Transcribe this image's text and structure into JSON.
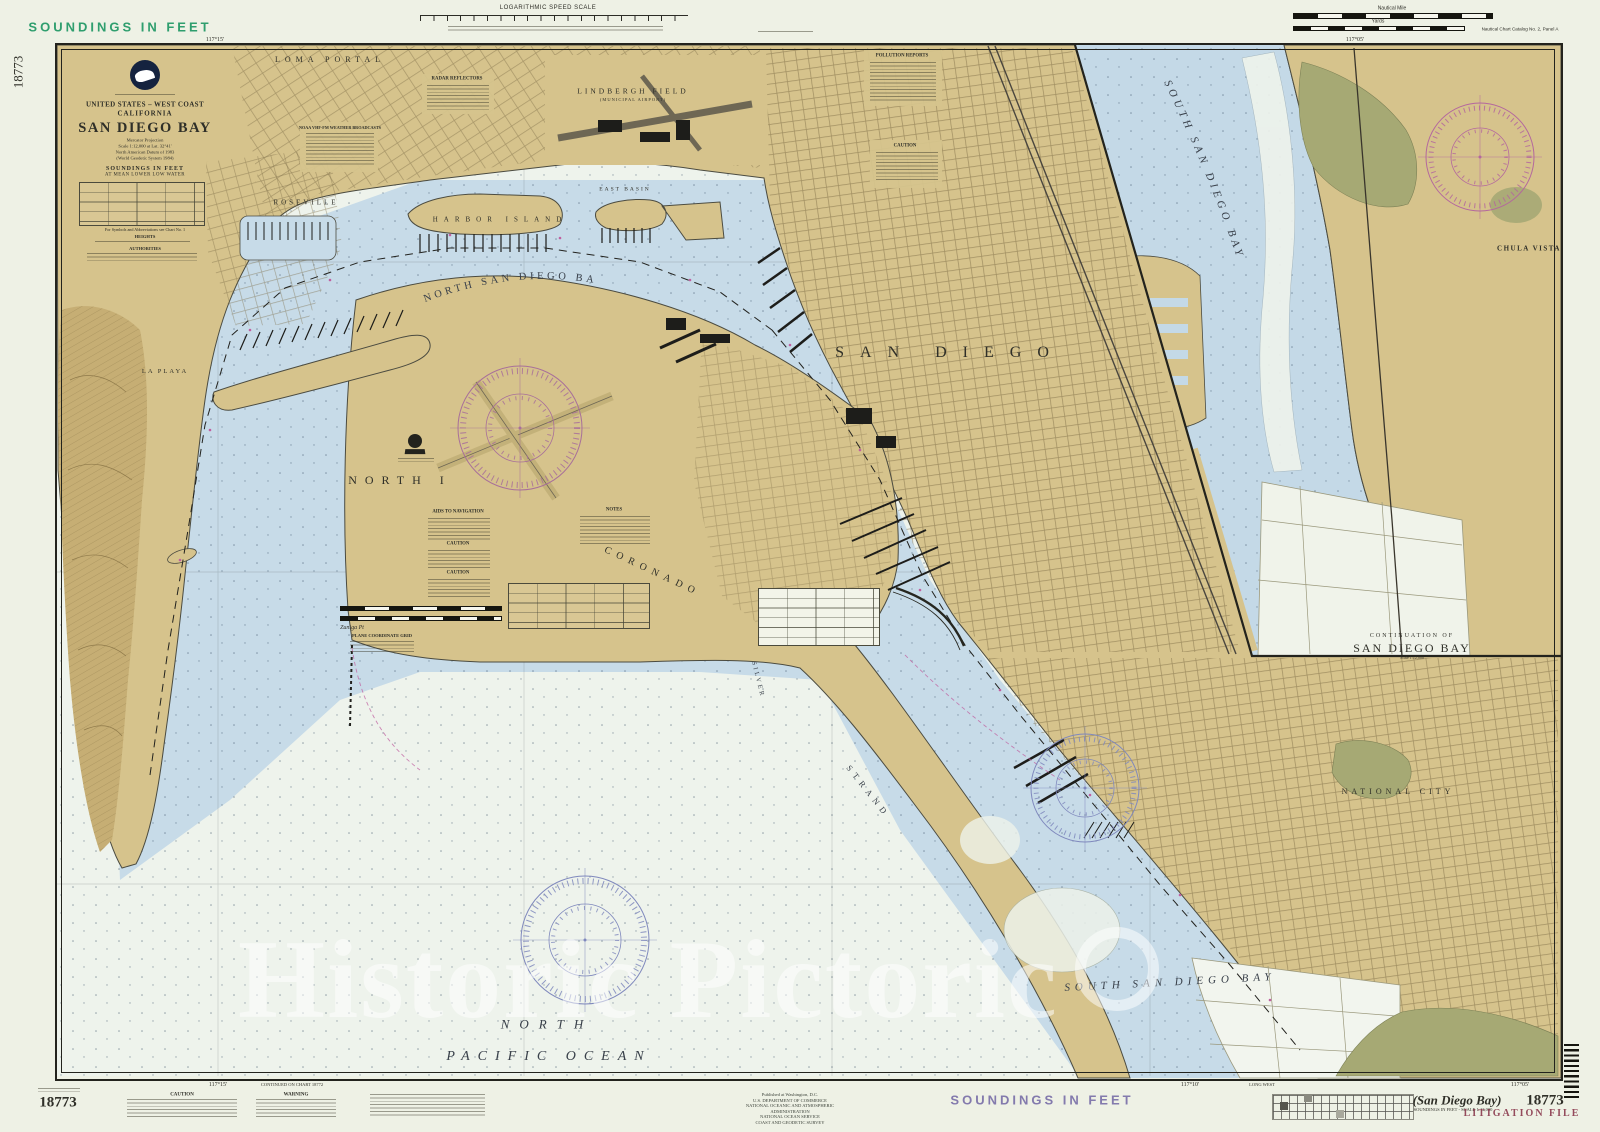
{
  "colors": {
    "paper": "#eef1e5",
    "bay_water": "#c7dbe8",
    "ocean": "#eef3ec",
    "land_tan": "#d6c38c",
    "marsh_green": "#a6a974",
    "hill_brown": "#c6ae74",
    "rose_magenta": "#a86f9a",
    "rose_blue": "#7f88bd",
    "margin_green": "#2f9e6e",
    "margin_purple": "#837aad",
    "litigation_red": "#8b3a4e",
    "ink": "#2f2f28"
  },
  "margins": {
    "soundings_top": "SOUNDINGS IN FEET",
    "soundings_bottom": "SOUNDINGS IN FEET",
    "side_number_left": "18773",
    "number_bottom_left": "18773",
    "number_bottom_right": "18773",
    "litigation_stamp": "LITIGATION FILE",
    "paren_title": "(San Diego Bay)",
    "paren_subtitle": "SOUNDINGS IN FEET - SCALE 1:12,000",
    "speed_scale": "LOGARITHMIC SPEED SCALE",
    "nautical_mile": "Nautical Mile",
    "yards": "Yards",
    "catalog_note": "Nautical Chart Catalog No. 2, Panel A",
    "continued_note": "CONTINUED ON CHART 18772",
    "long_west": "LONG WEST",
    "caution_header": "CAUTION",
    "warning_header": "WARNING",
    "publication_lines": [
      "Published at Washington, D.C.",
      "U.S. DEPARTMENT OF COMMERCE",
      "NATIONAL OCEANIC AND ATMOSPHERIC ADMINISTRATION",
      "NATIONAL OCEAN SERVICE",
      "COAST AND GEODETIC SURVEY"
    ],
    "tick_top_left": "117°15'",
    "tick_top_right": "117°05'",
    "tick_bottom_left": "117°15'",
    "tick_bottom_mid": "117°10'",
    "tick_bottom_right": "117°05'"
  },
  "title_block": {
    "region": "UNITED STATES – WEST COAST",
    "state": "CALIFORNIA",
    "title": "SAN DIEGO BAY",
    "proj1": "Mercator Projection",
    "proj2": "Scale 1:12,000 at Lat. 32°41'",
    "proj3": "North American Datum of 1983",
    "proj4": "(World Geodetic System 1984)",
    "soundings": "SOUNDINGS IN FEET",
    "datum": "AT MEAN LOWER LOW WATER",
    "symbols_note": "For Symbols and Abbreviations see Chart No. 1",
    "heights": "HEIGHTS",
    "authorities": "AUTHORITIES"
  },
  "labels": {
    "loma_portal": "LOMA PORTAL",
    "roseville": "ROSEVILLE",
    "la_playa": "LA PLAYA",
    "lindbergh": "LINDBERGH FIELD",
    "municipal": "(MUNICIPAL AIRPORT)",
    "harbor_island": "HARBOR ISLAND",
    "east_basin": "EAST BASIN",
    "north_bay": "NORTH SAN DIEGO BAY",
    "san_diego": "SAN DIEGO",
    "north_island": "NORTH I",
    "coronado": "CORONADO",
    "zuniga": "Zuniga Pt",
    "silver": "SILVER",
    "strand": "STRAND",
    "south_bay": "SOUTH SAN DIEGO BAY",
    "national_city": "NATIONAL CITY",
    "north_word": "NORTH",
    "pacific_ocean": "PACIFIC OCEAN"
  },
  "inset": {
    "continuation_of": "CONTINUATION OF",
    "name": "SAN DIEGO BAY",
    "scale": "Scale 1:12,000",
    "bay": "SOUTH SAN DIEGO BAY",
    "chula_vista": "CHULA VISTA"
  },
  "notes": {
    "radar": "RADAR REFLECTORS",
    "pollution": "POLLUTION REPORTS",
    "weather": "NOAA VHF-FM WEATHER BROADCASTS",
    "aids": "AIDS TO NAVIGATION",
    "caution": "CAUTION",
    "notes_header": "NOTES",
    "plane": "PLANE COORDINATE GRID"
  },
  "watermark": {
    "text": "Historic Pictoric"
  }
}
